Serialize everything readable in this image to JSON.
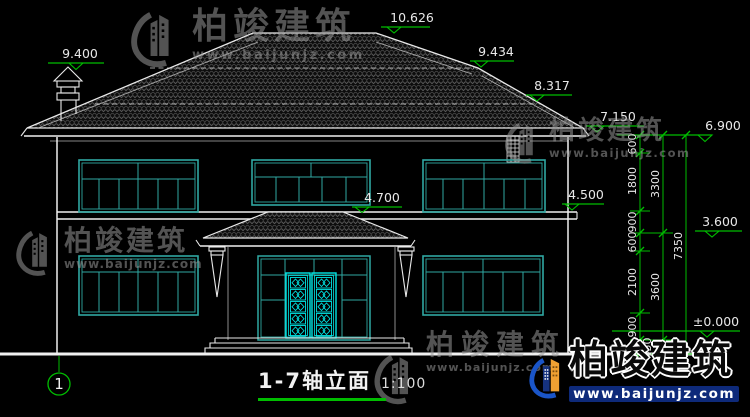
{
  "brand": {
    "name": "柏竣建筑",
    "site": "www.baijunjz.com"
  },
  "title_block": {
    "title": "1-7轴立面",
    "scale": "1:100",
    "axis_label": "1"
  },
  "elevations": {
    "ridge": "10.626",
    "chimney": "9.400",
    "upper_right": "9.434",
    "mid_right": "8.317",
    "right_eave": "7.150",
    "main_eave": "6.900",
    "porch_ridge": "4.700",
    "belt": "4.500",
    "porch_eave": "3.600",
    "zero": "±0.000"
  },
  "dims": {
    "inner": [
      "600",
      "1800",
      "900",
      "600",
      "2100",
      "900"
    ],
    "middle": [
      "3300",
      "3600"
    ],
    "plinth": "450",
    "total": "7350"
  },
  "colors": {
    "background": "#000000",
    "line": "#e9e9e9",
    "dimension_green": "#00bd00",
    "window_teal": "#2fa8a2",
    "door_cyan": "#00e5e5",
    "logo_blue": "#1a55c8",
    "logo_orange": "#f0a132"
  }
}
